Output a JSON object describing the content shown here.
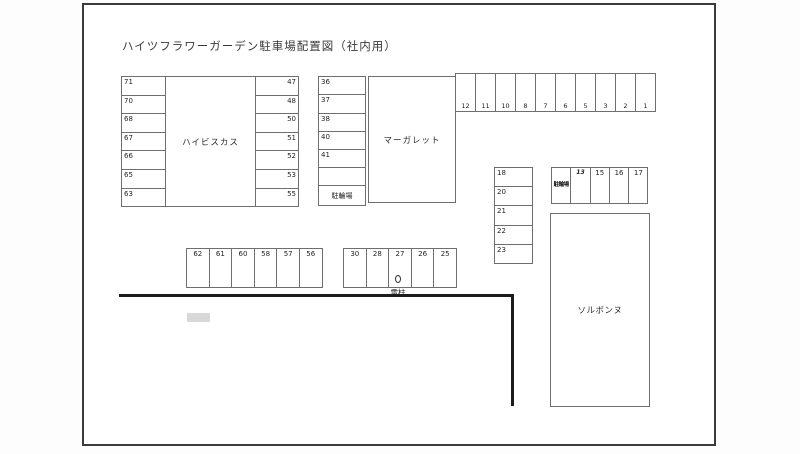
{
  "title": "ハイツフラワーガーデン駐車場配置図（社内用）",
  "buildings": {
    "hibiscus": "ハイビスカス",
    "margaret": "マーガレット",
    "sorbonne": "ソルボンヌ"
  },
  "labels": {
    "bike_parking_block2": "駐輪場",
    "bike_parking_small": "駐輪場",
    "utility_pole": "電柱"
  },
  "lots": {
    "block1_left": [
      "71",
      "70",
      "68",
      "67",
      "66",
      "65",
      "63"
    ],
    "block1_right": [
      "47",
      "48",
      "50",
      "51",
      "52",
      "53",
      "55"
    ],
    "block2_left": [
      "36",
      "37",
      "38",
      "40",
      "41",
      ""
    ],
    "top_row": [
      "12",
      "11",
      "10",
      "8",
      "7",
      "6",
      "5",
      "3",
      "2",
      "1"
    ],
    "mid_column": [
      "18",
      "20",
      "21",
      "22",
      "23"
    ],
    "small_block": [
      "13",
      "15",
      "16",
      "17"
    ],
    "bottom_row_a": [
      "62",
      "61",
      "60",
      "58",
      "57",
      "56"
    ],
    "bottom_row_b": [
      "30",
      "28",
      "27",
      "26",
      "25"
    ]
  },
  "colors": {
    "page_background": "#ffffff",
    "page_border": "#3b3b3b",
    "cell_border": "#6e6e6e",
    "road_line": "#1c1c1c",
    "gray_marker": "#d8d8d8"
  }
}
